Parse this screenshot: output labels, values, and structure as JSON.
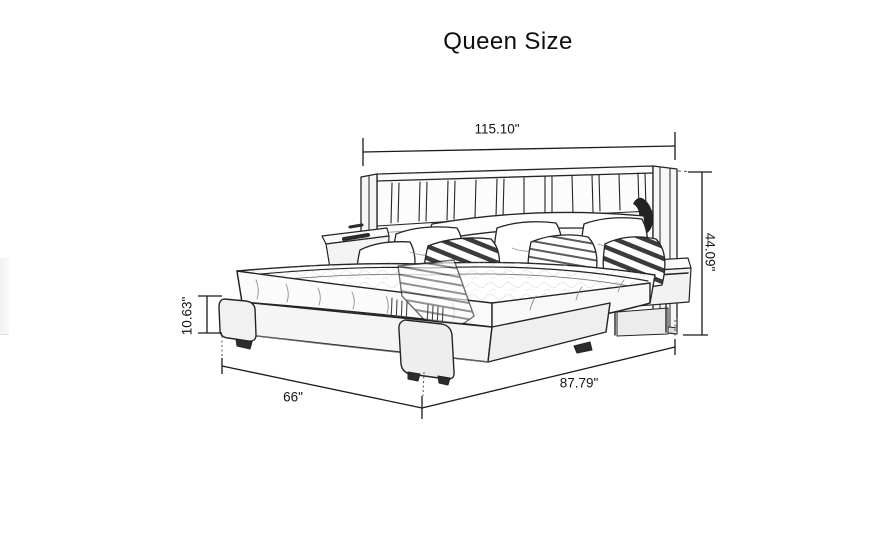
{
  "title": "Queen Size",
  "diagram": {
    "subject": "upholstered-bed-with-wing-headboard-and-floating-nightstands",
    "style": "pencil-sketch line drawing",
    "unit": "inches",
    "dimensions": [
      {
        "id": "overall-width",
        "label": "115.10\"",
        "placement": "top"
      },
      {
        "id": "overall-height",
        "label": "44.09\"",
        "placement": "right"
      },
      {
        "id": "base-height",
        "label": "10.63\"",
        "placement": "left"
      },
      {
        "id": "frame-width",
        "label": "66\"",
        "placement": "bottom-left"
      },
      {
        "id": "frame-depth",
        "label": "87.79\"",
        "placement": "bottom-right"
      }
    ],
    "colors": {
      "background": "#ffffff",
      "sketch_line": "#222222",
      "dimension_line": "#1a1a1a",
      "text": "#141414",
      "shading_light": "#f3f3f3",
      "accent_dark": "#2a2a2a"
    }
  }
}
